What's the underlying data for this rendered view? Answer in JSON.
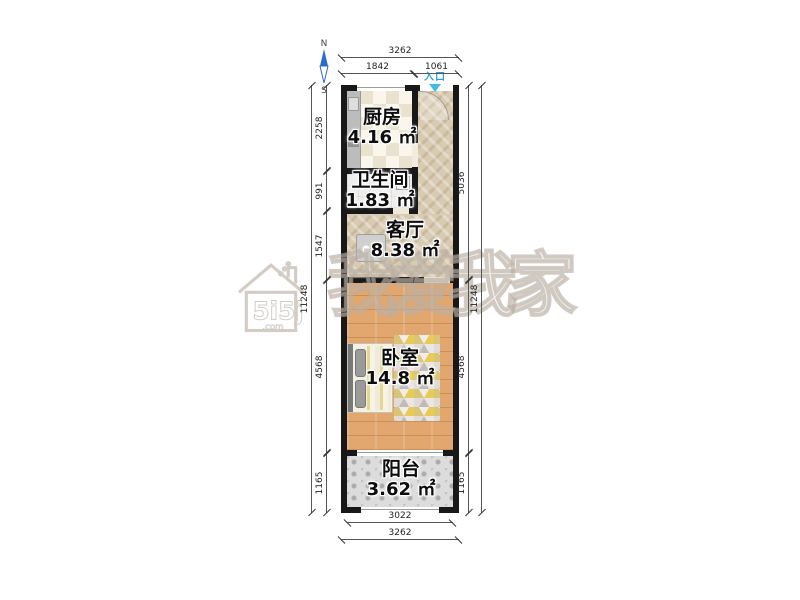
{
  "compass": {
    "north_label": "N",
    "south_label": "S"
  },
  "entrance": {
    "label": "入口"
  },
  "rooms": {
    "kitchen": {
      "name": "厨房",
      "area": "4.16 ㎡"
    },
    "bathroom": {
      "name": "卫生间",
      "area": "1.83 ㎡"
    },
    "living_room": {
      "name": "客厅",
      "area": "8.38 ㎡"
    },
    "bedroom": {
      "name": "卧室",
      "area": "14.8 ㎡"
    },
    "balcony": {
      "name": "阳台",
      "area": "3.62 ㎡"
    }
  },
  "dimensions_mm": {
    "top_total": "3262",
    "top_segments": [
      "1842",
      "1061"
    ],
    "left_total": "11248",
    "left_segments": [
      "2258",
      "991",
      "1547",
      "4568",
      "1165"
    ],
    "right_total": "11248",
    "right_segments": [
      "5036",
      "4568",
      "1165"
    ],
    "bottom_inner": "3022",
    "bottom_outer": "3262"
  },
  "watermark": {
    "brand_text": "我爱我家",
    "logo_text": "5i5j",
    "logo_suffix": ".com"
  },
  "colors": {
    "wall": "#181818",
    "entrance_blue": "#2e9fd4",
    "compass_blue": "#2b6fc4",
    "bedroom_floor": "#e2a76e",
    "hall_floor": "#d8cbb2",
    "watermark_gray": "#b8aea2"
  }
}
